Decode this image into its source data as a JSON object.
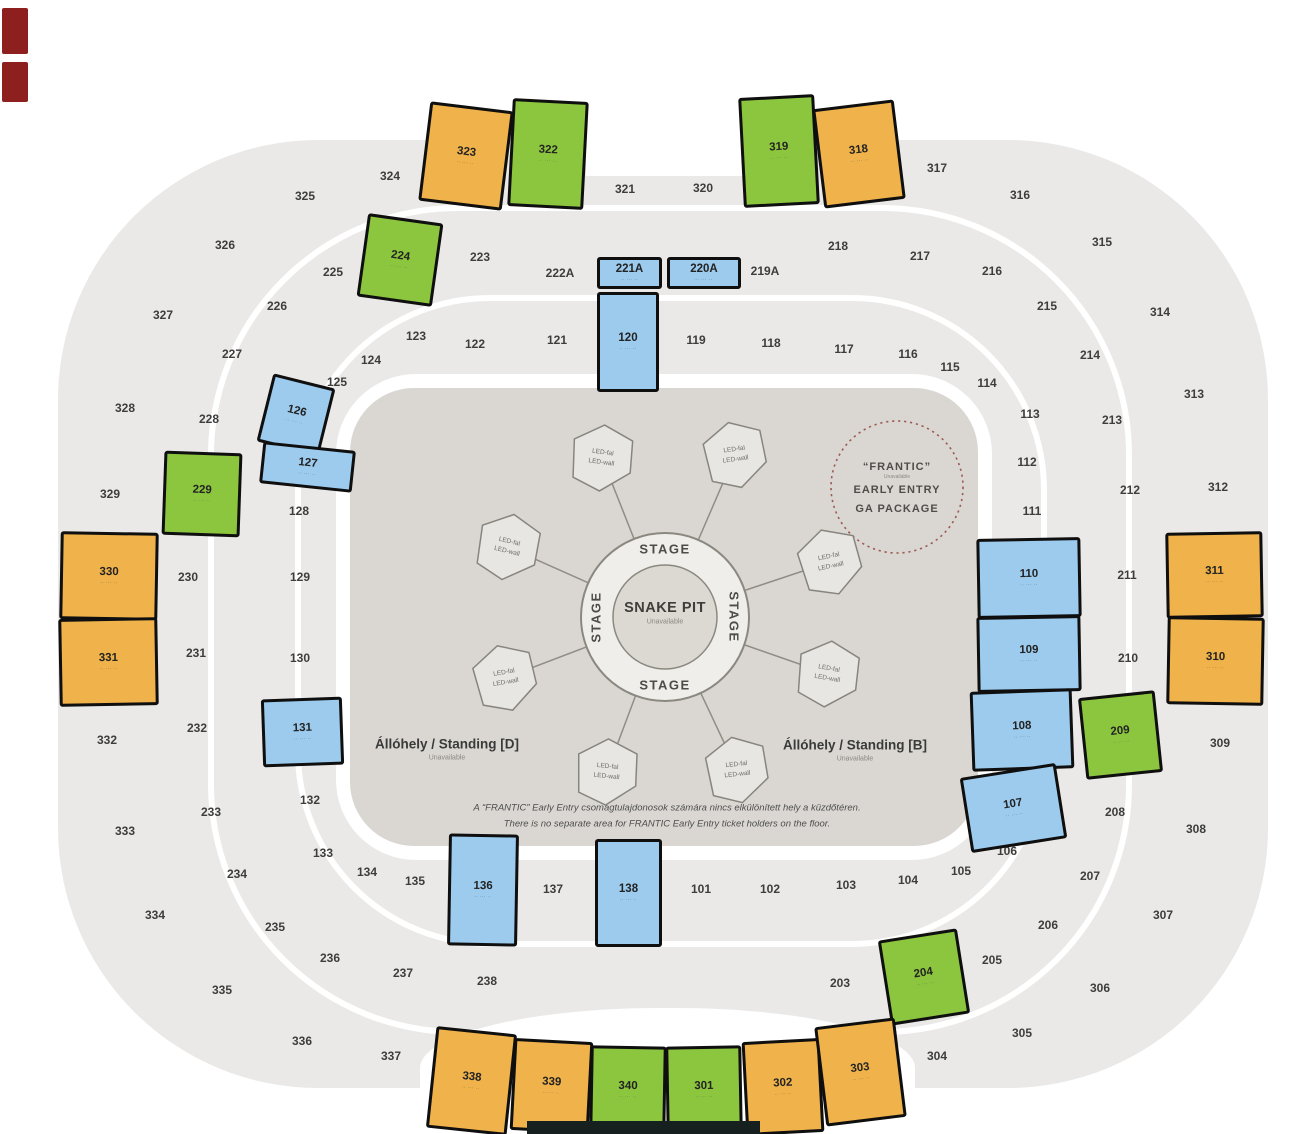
{
  "colors": {
    "orange": "#F0B24A",
    "green": "#8CC63F",
    "blue": "#9CCBEE",
    "ring_gray": "#EAE9E8",
    "floor": "#DAD7D2",
    "pod": "#E7E6E3",
    "frantic_dash": "#9B5A52",
    "outline": "#0F0F0F"
  },
  "floor": {
    "stage_label": "STAGE",
    "snake_pit": {
      "title": "SNAKE PIT",
      "status": "Unavailable"
    },
    "led": {
      "line1": "LED-fal",
      "line2": "LED-wall",
      "pods": [
        {
          "x": 602,
          "y": 458,
          "r": 8
        },
        {
          "x": 735,
          "y": 455,
          "r": -8
        },
        {
          "x": 508,
          "y": 547,
          "r": 14
        },
        {
          "x": 830,
          "y": 562,
          "r": -12
        },
        {
          "x": 505,
          "y": 678,
          "r": -10
        },
        {
          "x": 828,
          "y": 674,
          "r": 10
        },
        {
          "x": 607,
          "y": 772,
          "r": 6
        },
        {
          "x": 737,
          "y": 770,
          "r": -6
        }
      ]
    },
    "frantic": {
      "line1": "“FRANTIC”",
      "status": "Unavailable",
      "line2": "EARLY ENTRY",
      "line3": "GA PACKAGE"
    },
    "standing_d": {
      "label": "Állóhely / Standing [D]",
      "status": "Unavailable"
    },
    "standing_b": {
      "label": "Állóhely / Standing [B]",
      "status": "Unavailable"
    },
    "note_hu": "A “FRANTIC” Early Entry csomagtulajdonosok számára nincs elkülönített hely a küzdőtéren.",
    "note_en": "There is no separate area for FRANTIC Early Entry ticket holders on the floor."
  },
  "sections": {
    "subtext": "·· ··· ··",
    "colored": [
      {
        "label": "323",
        "color": "orange",
        "x": 424,
        "y": 106,
        "w": 84,
        "h": 100,
        "r": 7
      },
      {
        "label": "322",
        "color": "green",
        "x": 510,
        "y": 100,
        "w": 76,
        "h": 108,
        "r": 3
      },
      {
        "label": "319",
        "color": "green",
        "x": 741,
        "y": 96,
        "w": 76,
        "h": 110,
        "r": -3
      },
      {
        "label": "318",
        "color": "orange",
        "x": 818,
        "y": 104,
        "w": 82,
        "h": 100,
        "r": -7
      },
      {
        "label": "224",
        "color": "green",
        "x": 362,
        "y": 218,
        "w": 76,
        "h": 84,
        "r": 8
      },
      {
        "label": "229",
        "color": "green",
        "x": 163,
        "y": 452,
        "w": 78,
        "h": 84,
        "r": 2
      },
      {
        "label": "330",
        "color": "orange",
        "x": 60,
        "y": 532,
        "w": 98,
        "h": 88,
        "r": 1
      },
      {
        "label": "331",
        "color": "orange",
        "x": 59,
        "y": 618,
        "w": 99,
        "h": 88,
        "r": -1
      },
      {
        "label": "311",
        "color": "orange",
        "x": 1166,
        "y": 532,
        "w": 97,
        "h": 86,
        "r": -1
      },
      {
        "label": "310",
        "color": "orange",
        "x": 1167,
        "y": 617,
        "w": 97,
        "h": 88,
        "r": 1
      },
      {
        "label": "209",
        "color": "green",
        "x": 1082,
        "y": 694,
        "w": 77,
        "h": 82,
        "r": -6
      },
      {
        "label": "204",
        "color": "green",
        "x": 884,
        "y": 934,
        "w": 80,
        "h": 86,
        "r": -9
      },
      {
        "label": "338",
        "color": "orange",
        "x": 431,
        "y": 1030,
        "w": 81,
        "h": 102,
        "r": 6
      },
      {
        "label": "339",
        "color": "orange",
        "x": 512,
        "y": 1040,
        "w": 79,
        "h": 92,
        "r": 3
      },
      {
        "label": "340",
        "color": "green",
        "x": 590,
        "y": 1046,
        "w": 76,
        "h": 88,
        "r": 1
      },
      {
        "label": "301",
        "color": "green",
        "x": 666,
        "y": 1046,
        "w": 76,
        "h": 88,
        "r": -1
      },
      {
        "label": "302",
        "color": "orange",
        "x": 744,
        "y": 1040,
        "w": 78,
        "h": 94,
        "r": -3
      },
      {
        "label": "303",
        "color": "orange",
        "x": 820,
        "y": 1022,
        "w": 81,
        "h": 100,
        "r": -7
      },
      {
        "label": "221A",
        "color": "blue",
        "x": 597,
        "y": 257,
        "w": 65,
        "h": 32,
        "r": 0
      },
      {
        "label": "220A",
        "color": "blue",
        "x": 667,
        "y": 257,
        "w": 74,
        "h": 32,
        "r": 0
      },
      {
        "label": "120",
        "color": "blue",
        "x": 597,
        "y": 292,
        "w": 62,
        "h": 100,
        "r": 0
      },
      {
        "label": "126",
        "color": "blue",
        "x": 264,
        "y": 380,
        "w": 64,
        "h": 70,
        "r": 14
      },
      {
        "label": "127",
        "color": "blue",
        "x": 261,
        "y": 446,
        "w": 93,
        "h": 42,
        "r": 6
      },
      {
        "label": "131",
        "color": "blue",
        "x": 262,
        "y": 698,
        "w": 81,
        "h": 68,
        "r": -2
      },
      {
        "label": "136",
        "color": "blue",
        "x": 448,
        "y": 834,
        "w": 70,
        "h": 112,
        "r": 1
      },
      {
        "label": "138",
        "color": "blue",
        "x": 595,
        "y": 839,
        "w": 67,
        "h": 108,
        "r": 0
      },
      {
        "label": "110",
        "color": "blue",
        "x": 977,
        "y": 538,
        "w": 104,
        "h": 80,
        "r": -1
      },
      {
        "label": "109",
        "color": "blue",
        "x": 977,
        "y": 616,
        "w": 104,
        "h": 76,
        "r": -1
      },
      {
        "label": "108",
        "color": "blue",
        "x": 971,
        "y": 690,
        "w": 102,
        "h": 80,
        "r": -2
      },
      {
        "label": "107",
        "color": "blue",
        "x": 965,
        "y": 770,
        "w": 97,
        "h": 76,
        "r": -9
      }
    ],
    "gray": [
      {
        "label": "101",
        "x": 701,
        "y": 889
      },
      {
        "label": "102",
        "x": 770,
        "y": 889
      },
      {
        "label": "103",
        "x": 846,
        "y": 885
      },
      {
        "label": "104",
        "x": 908,
        "y": 880
      },
      {
        "label": "105",
        "x": 961,
        "y": 871
      },
      {
        "label": "106",
        "x": 1007,
        "y": 851
      },
      {
        "label": "111",
        "x": 1032,
        "y": 511
      },
      {
        "label": "112",
        "x": 1027,
        "y": 462
      },
      {
        "label": "113",
        "x": 1030,
        "y": 414
      },
      {
        "label": "114",
        "x": 987,
        "y": 383
      },
      {
        "label": "115",
        "x": 950,
        "y": 367
      },
      {
        "label": "116",
        "x": 908,
        "y": 354
      },
      {
        "label": "117",
        "x": 844,
        "y": 349
      },
      {
        "label": "118",
        "x": 771,
        "y": 343
      },
      {
        "label": "119",
        "x": 696,
        "y": 340
      },
      {
        "label": "121",
        "x": 557,
        "y": 340
      },
      {
        "label": "122",
        "x": 475,
        "y": 344
      },
      {
        "label": "123",
        "x": 416,
        "y": 336
      },
      {
        "label": "124",
        "x": 371,
        "y": 360
      },
      {
        "label": "125",
        "x": 337,
        "y": 382
      },
      {
        "label": "128",
        "x": 299,
        "y": 511
      },
      {
        "label": "129",
        "x": 300,
        "y": 577
      },
      {
        "label": "130",
        "x": 300,
        "y": 658
      },
      {
        "label": "132",
        "x": 310,
        "y": 800
      },
      {
        "label": "133",
        "x": 323,
        "y": 853
      },
      {
        "label": "134",
        "x": 367,
        "y": 872
      },
      {
        "label": "135",
        "x": 415,
        "y": 881
      },
      {
        "label": "137",
        "x": 553,
        "y": 889
      },
      {
        "label": "203",
        "x": 840,
        "y": 983
      },
      {
        "label": "205",
        "x": 992,
        "y": 960
      },
      {
        "label": "206",
        "x": 1048,
        "y": 925
      },
      {
        "label": "207",
        "x": 1090,
        "y": 876
      },
      {
        "label": "208",
        "x": 1115,
        "y": 812
      },
      {
        "label": "210",
        "x": 1128,
        "y": 658
      },
      {
        "label": "211",
        "x": 1127,
        "y": 575
      },
      {
        "label": "212",
        "x": 1130,
        "y": 490
      },
      {
        "label": "213",
        "x": 1112,
        "y": 420
      },
      {
        "label": "214",
        "x": 1090,
        "y": 355
      },
      {
        "label": "215",
        "x": 1047,
        "y": 306
      },
      {
        "label": "216",
        "x": 992,
        "y": 271
      },
      {
        "label": "217",
        "x": 920,
        "y": 256
      },
      {
        "label": "218",
        "x": 838,
        "y": 246
      },
      {
        "label": "219A",
        "x": 765,
        "y": 271
      },
      {
        "label": "222A",
        "x": 560,
        "y": 273
      },
      {
        "label": "223",
        "x": 480,
        "y": 257
      },
      {
        "label": "225",
        "x": 333,
        "y": 272
      },
      {
        "label": "226",
        "x": 277,
        "y": 306
      },
      {
        "label": "227",
        "x": 232,
        "y": 354
      },
      {
        "label": "228",
        "x": 209,
        "y": 419
      },
      {
        "label": "230",
        "x": 188,
        "y": 577
      },
      {
        "label": "231",
        "x": 196,
        "y": 653
      },
      {
        "label": "232",
        "x": 197,
        "y": 728
      },
      {
        "label": "233",
        "x": 211,
        "y": 812
      },
      {
        "label": "234",
        "x": 237,
        "y": 874
      },
      {
        "label": "235",
        "x": 275,
        "y": 927
      },
      {
        "label": "236",
        "x": 330,
        "y": 958
      },
      {
        "label": "237",
        "x": 403,
        "y": 973
      },
      {
        "label": "238",
        "x": 487,
        "y": 981
      },
      {
        "label": "304",
        "x": 937,
        "y": 1056
      },
      {
        "label": "305",
        "x": 1022,
        "y": 1033
      },
      {
        "label": "306",
        "x": 1100,
        "y": 988
      },
      {
        "label": "307",
        "x": 1163,
        "y": 915
      },
      {
        "label": "308",
        "x": 1196,
        "y": 829
      },
      {
        "label": "309",
        "x": 1220,
        "y": 743
      },
      {
        "label": "312",
        "x": 1218,
        "y": 487
      },
      {
        "label": "313",
        "x": 1194,
        "y": 394
      },
      {
        "label": "314",
        "x": 1160,
        "y": 312
      },
      {
        "label": "315",
        "x": 1102,
        "y": 242
      },
      {
        "label": "316",
        "x": 1020,
        "y": 195
      },
      {
        "label": "317",
        "x": 937,
        "y": 168
      },
      {
        "label": "320",
        "x": 703,
        "y": 188
      },
      {
        "label": "321",
        "x": 625,
        "y": 189
      },
      {
        "label": "324",
        "x": 390,
        "y": 176
      },
      {
        "label": "325",
        "x": 305,
        "y": 196
      },
      {
        "label": "326",
        "x": 225,
        "y": 245
      },
      {
        "label": "327",
        "x": 163,
        "y": 315
      },
      {
        "label": "328",
        "x": 125,
        "y": 408
      },
      {
        "label": "329",
        "x": 110,
        "y": 494
      },
      {
        "label": "332",
        "x": 107,
        "y": 740
      },
      {
        "label": "333",
        "x": 125,
        "y": 831
      },
      {
        "label": "334",
        "x": 155,
        "y": 915
      },
      {
        "label": "335",
        "x": 222,
        "y": 990
      },
      {
        "label": "336",
        "x": 302,
        "y": 1041
      },
      {
        "label": "337",
        "x": 391,
        "y": 1056
      }
    ]
  }
}
